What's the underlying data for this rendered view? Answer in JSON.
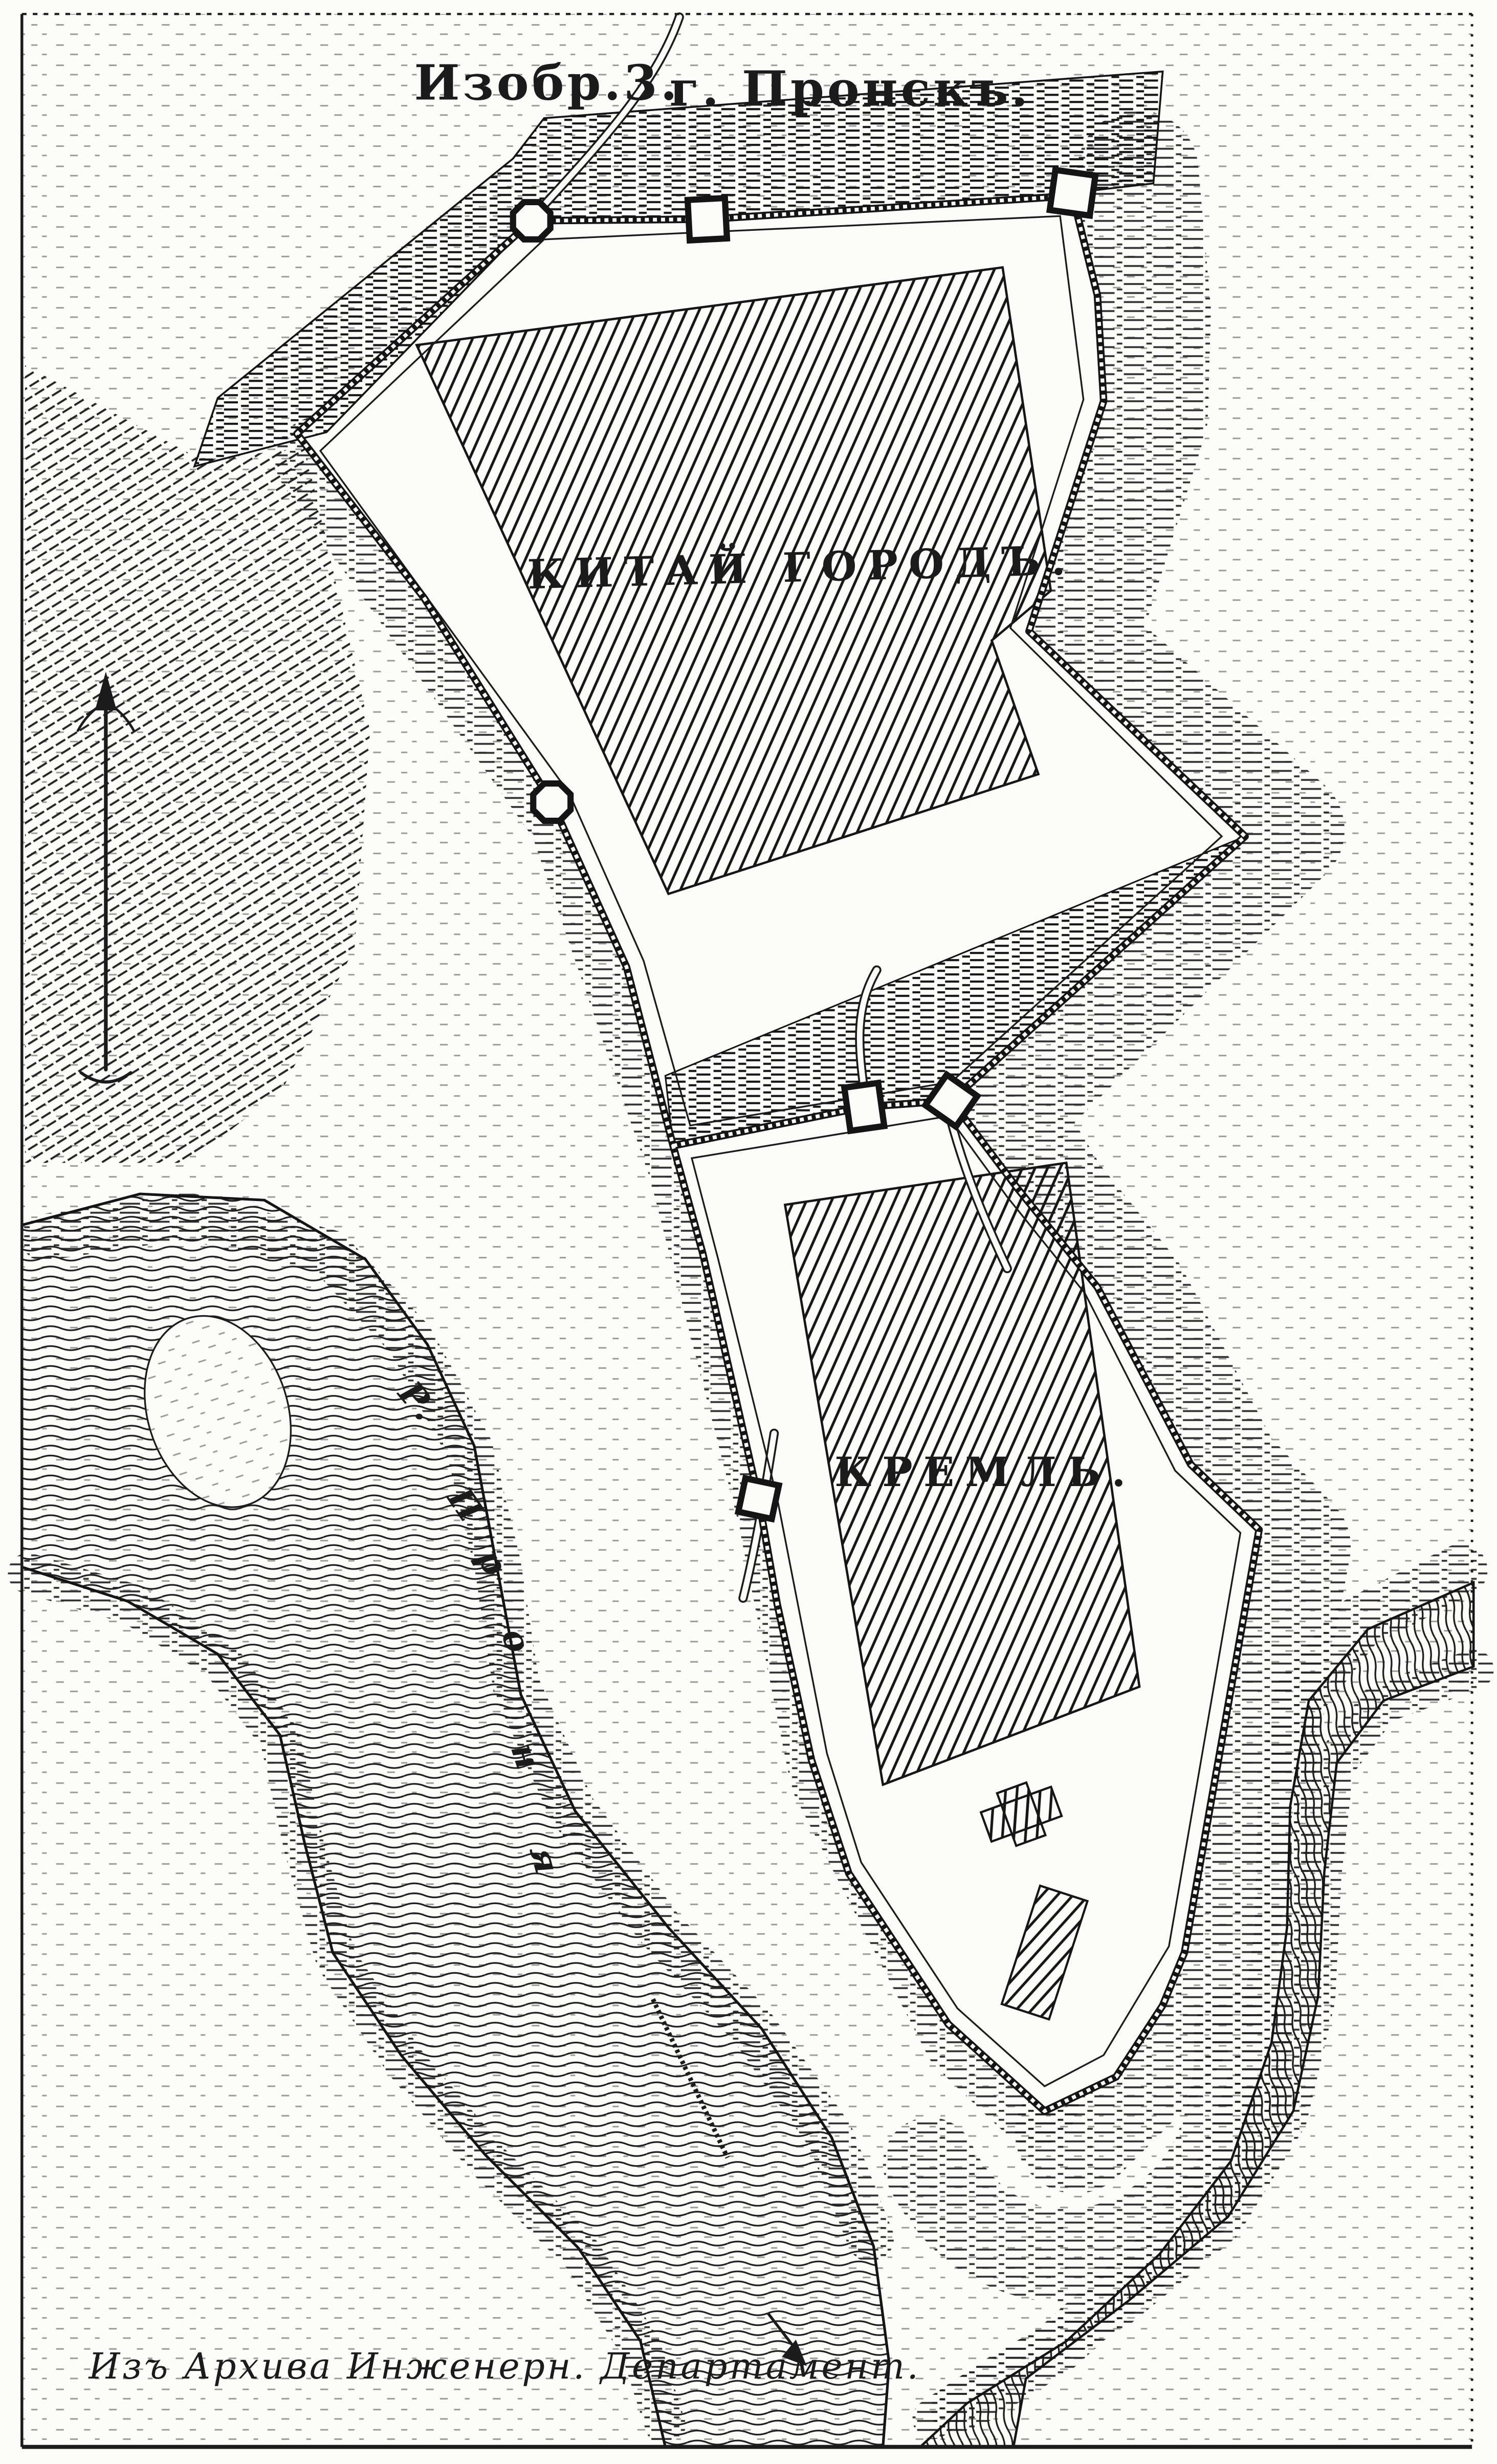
{
  "map": {
    "title": {
      "figure_no": "Изобр.3.",
      "city": "г. Пронскъ."
    },
    "areas": {
      "kitai_gorod": "КИТАЙ ГОРОДЪ.",
      "kremlin": "КРЕМЛЬ."
    },
    "river_name": "Р. Проня",
    "river_label_letters": [
      "Р.",
      "П",
      "р",
      "о",
      "н",
      "я"
    ],
    "caption": "Изъ Архива Инженерн. Департамент.",
    "compass": "north-arrow",
    "colors": {
      "ink": "#1b1b1b",
      "paper": "#fcfcfa",
      "hatch": "#161616"
    }
  }
}
